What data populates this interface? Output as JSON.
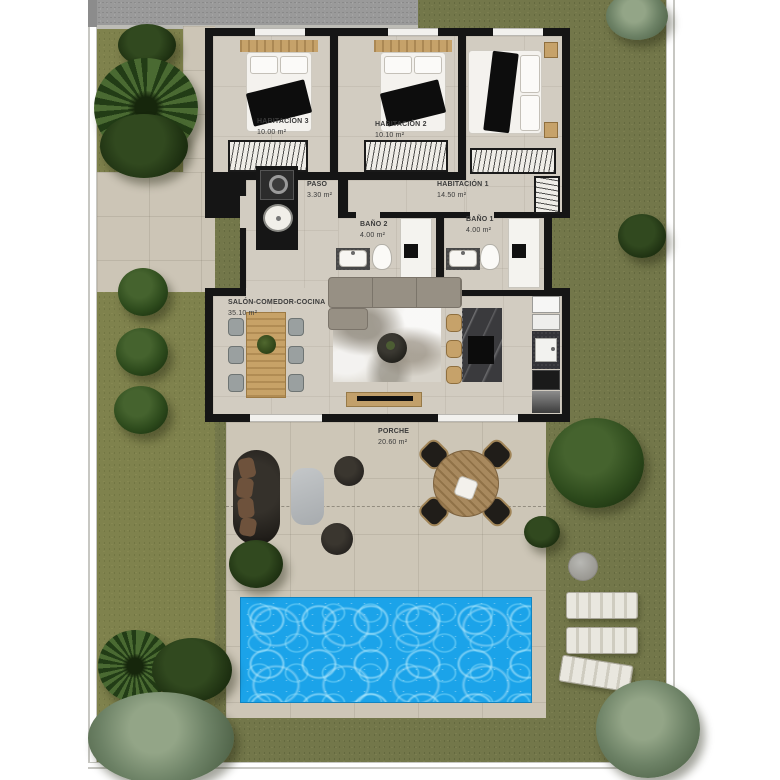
{
  "rooms": [
    {
      "name": "HABITACIÓN 3",
      "area": "10.00 m²"
    },
    {
      "name": "HABITACIÓN 2",
      "area": "10.10 m²"
    },
    {
      "name": "HABITACIÓN 1",
      "area": "14.50 m²"
    },
    {
      "name": "PASO",
      "area": "3.30 m²"
    },
    {
      "name": "BAÑO 2",
      "area": "4.00 m²"
    },
    {
      "name": "BAÑO 1",
      "area": "4.00 m²"
    },
    {
      "name": "SALÓN-COMEDOR-COCINA",
      "area": "35.10 m²"
    },
    {
      "name": "PORCHE",
      "area": "20.60 m²"
    }
  ],
  "colors": {
    "pool_water": "#1ba3e9",
    "grass": "#73774a",
    "wall": "#151515",
    "interior_floor": "#d2ccc1",
    "exterior_paving": "#cdc6b7",
    "driveway": "#9a9a9a",
    "wood_accent": "#c6a26a",
    "label_text": "#3a3a3a"
  }
}
